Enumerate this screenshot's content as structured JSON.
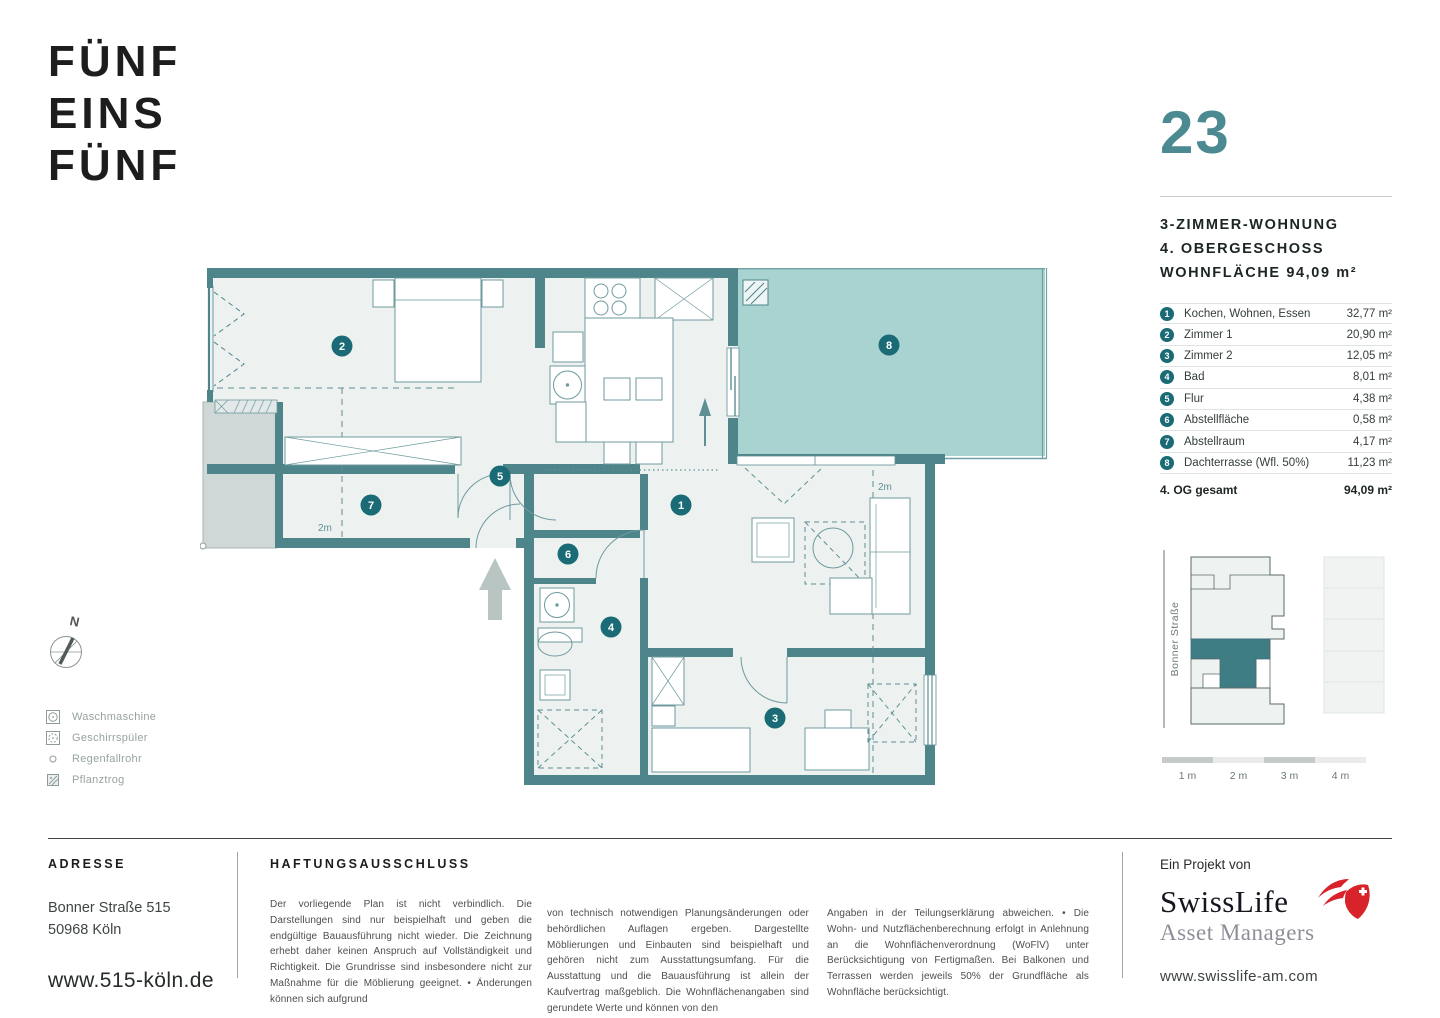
{
  "logo": {
    "line1": "FÜNF",
    "line2": "EINS",
    "line3": "FÜNF"
  },
  "unit": {
    "number": "23",
    "type": "3-ZIMMER-WOHNUNG",
    "floor": "4. OBERGESCHOSS",
    "area": "WOHNFLÄCHE 94,09 m²"
  },
  "rooms": [
    {
      "num": "1",
      "label": "Kochen, Wohnen, Essen",
      "area": "32,77 m²"
    },
    {
      "num": "2",
      "label": "Zimmer 1",
      "area": "20,90 m²"
    },
    {
      "num": "3",
      "label": "Zimmer 2",
      "area": "12,05 m²"
    },
    {
      "num": "4",
      "label": "Bad",
      "area": "8,01 m²"
    },
    {
      "num": "5",
      "label": "Flur",
      "area": "4,38 m²"
    },
    {
      "num": "6",
      "label": "Abstellfläche",
      "area": "0,58 m²"
    },
    {
      "num": "7",
      "label": "Abstellraum",
      "area": "4,17 m²"
    },
    {
      "num": "8",
      "label": "Dachterrasse (Wfl. 50%)",
      "area": "11,23 m²"
    }
  ],
  "total": {
    "label": "4. OG gesamt",
    "area": "94,09 m²"
  },
  "plan": {
    "compass_label": "N",
    "dim_left": "2m",
    "dim_right": "2m"
  },
  "legend": [
    {
      "label": "Waschmaschine"
    },
    {
      "label": "Geschirrspüler"
    },
    {
      "label": "Regenfallrohr"
    },
    {
      "label": "Pflanztrog"
    }
  ],
  "siteplan": {
    "street": "Bonner Straße"
  },
  "scalebar": {
    "l1": "1 m",
    "l2": "2 m",
    "l3": "3 m",
    "l4": "4 m"
  },
  "footer": {
    "address": {
      "heading": "ADRESSE",
      "line1": "Bonner Straße 515",
      "line2": "50968 Köln",
      "website": "www.515-köln.de"
    },
    "disclaimer": {
      "heading": "HAFTUNGSAUSSCHLUSS",
      "col1": "Der vorliegende Plan ist nicht verbindlich. Die Darstellungen sind nur beispielhaft und geben die endgültige Bauausführung nicht wieder. Die Zeichnung erhebt daher keinen Anspruch auf Vollständigkeit und Richtigkeit. Die Grundrisse sind insbesondere nicht zur Maßnahme für die Möblierung geeignet.  •  Änderungen können sich aufgrund",
      "col2": "von technisch notwendigen Planungsänderungen oder behördlichen Auflagen ergeben. Dargestellte Möblierungen und Einbauten sind beispielhaft und gehören nicht zum Ausstattungsumfang. Für die Ausstattung und die Bauausführung ist allein der Kaufvertrag maßgeblich. Die Wohnflächenangaben sind gerundete Werte und können von den",
      "col3": "Angaben in der Teilungserklärung abweichen.  •  Die Wohn- und Nutzflächenberechnung erfolgt in Anlehnung an die Wohnflächenverordnung (WoFlV) unter Berücksichtigung von Fertigmaßen. Bei Balkonen und Terrassen werden jeweils 50% der Grundfläche als Wohnfläche berücksichtigt."
    },
    "project": {
      "intro": "Ein Projekt von",
      "brand_line1": "SwissLife",
      "brand_line2": "Asset Managers",
      "website": "www.swisslife-am.com"
    }
  },
  "colors": {
    "wall_teal": "#4d858b",
    "terrace_fill": "#a9d3d1",
    "room_fill": "#edf2f1",
    "badge_teal": "#1a6b76",
    "unit_number": "#4b8a90",
    "swisslife_red": "#d8232a"
  }
}
